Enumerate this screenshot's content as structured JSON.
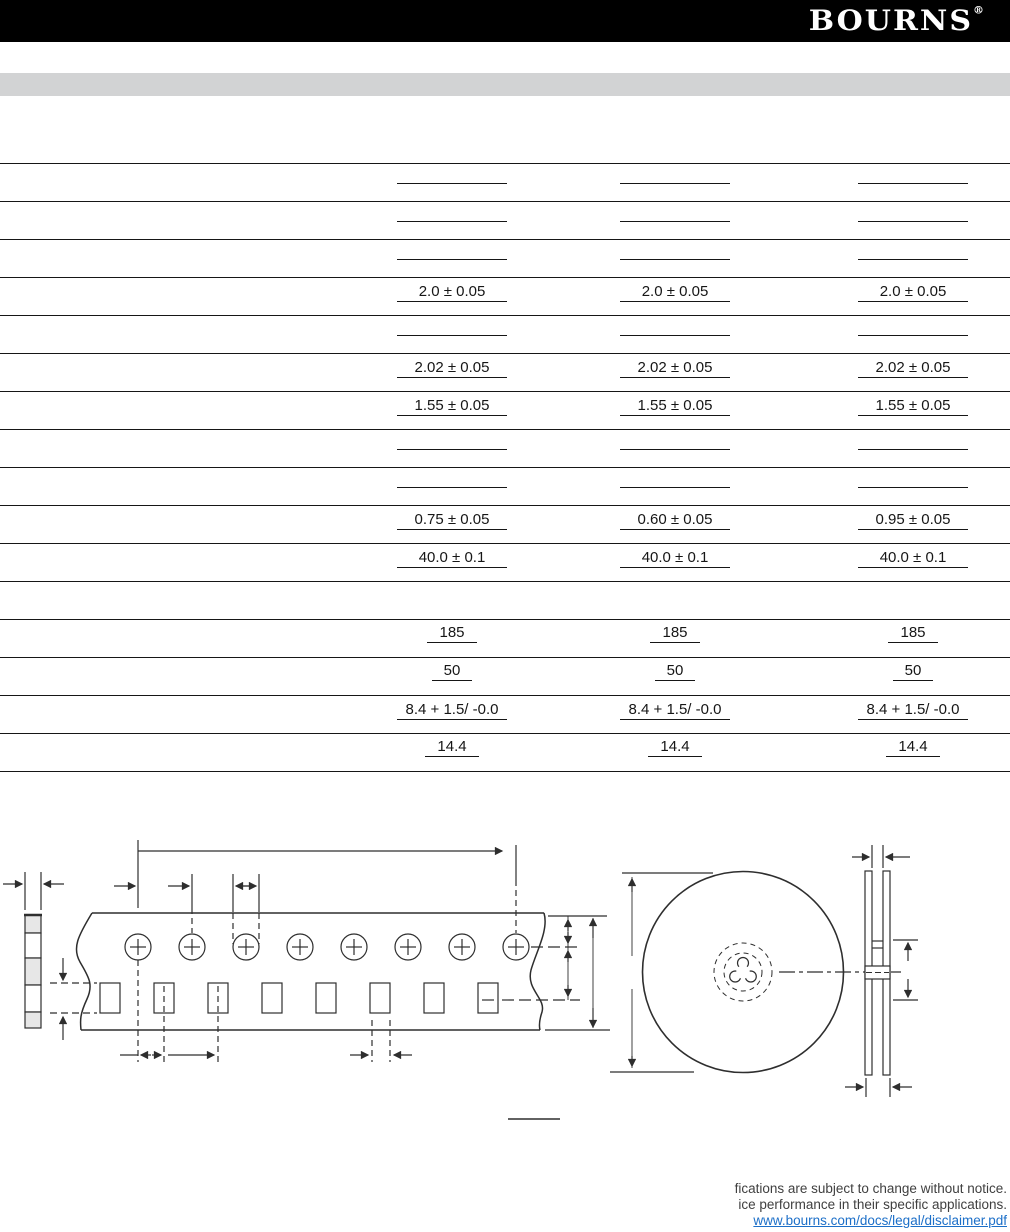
{
  "header": {
    "logo_text": "BOURNS",
    "registered_mark": "®"
  },
  "spec_table": {
    "rows": [
      {
        "style": "blank",
        "cells": [
          "",
          "",
          ""
        ]
      },
      {
        "style": "blank",
        "cells": [
          "",
          "",
          ""
        ]
      },
      {
        "style": "blank",
        "cells": [
          "",
          "",
          ""
        ]
      },
      {
        "style": "wide",
        "cells": [
          "2.0 ± 0.05",
          "2.0 ± 0.05",
          "2.0 ± 0.05"
        ]
      },
      {
        "style": "blank",
        "cells": [
          "",
          "",
          ""
        ]
      },
      {
        "style": "wide",
        "cells": [
          "2.02 ± 0.05",
          "2.02 ± 0.05",
          "2.02 ± 0.05"
        ]
      },
      {
        "style": "wide",
        "cells": [
          "1.55 ± 0.05",
          "1.55 ± 0.05",
          "1.55 ± 0.05"
        ]
      },
      {
        "style": "blank",
        "cells": [
          "",
          "",
          ""
        ]
      },
      {
        "style": "blank",
        "cells": [
          "",
          "",
          ""
        ]
      },
      {
        "style": "wide",
        "cells": [
          "0.75 ± 0.05",
          "0.60 ± 0.05",
          "0.95 ± 0.05"
        ]
      },
      {
        "style": "wide",
        "cells": [
          "40.0 ± 0.1",
          "40.0 ± 0.1",
          "40.0 ± 0.1"
        ]
      },
      {
        "style": "spacer",
        "cells": [
          "",
          "",
          ""
        ]
      },
      {
        "style": "fit",
        "cells": [
          "185",
          "185",
          "185"
        ]
      },
      {
        "style": "fit",
        "cells": [
          "50",
          "50",
          "50"
        ]
      },
      {
        "style": "wide",
        "cells": [
          "8.4 + 1.5/ -0.0",
          "8.4 + 1.5/ -0.0",
          "8.4 + 1.5/ -0.0"
        ]
      },
      {
        "style": "fit",
        "cells": [
          "14.4",
          "14.4",
          "14.4"
        ]
      }
    ]
  },
  "footer": {
    "line1": "fications are subject to change without notice.",
    "line2": "ice performance in their specific applications.",
    "link": "www.bourns.com/docs/legal/disclaimer.pdf"
  }
}
